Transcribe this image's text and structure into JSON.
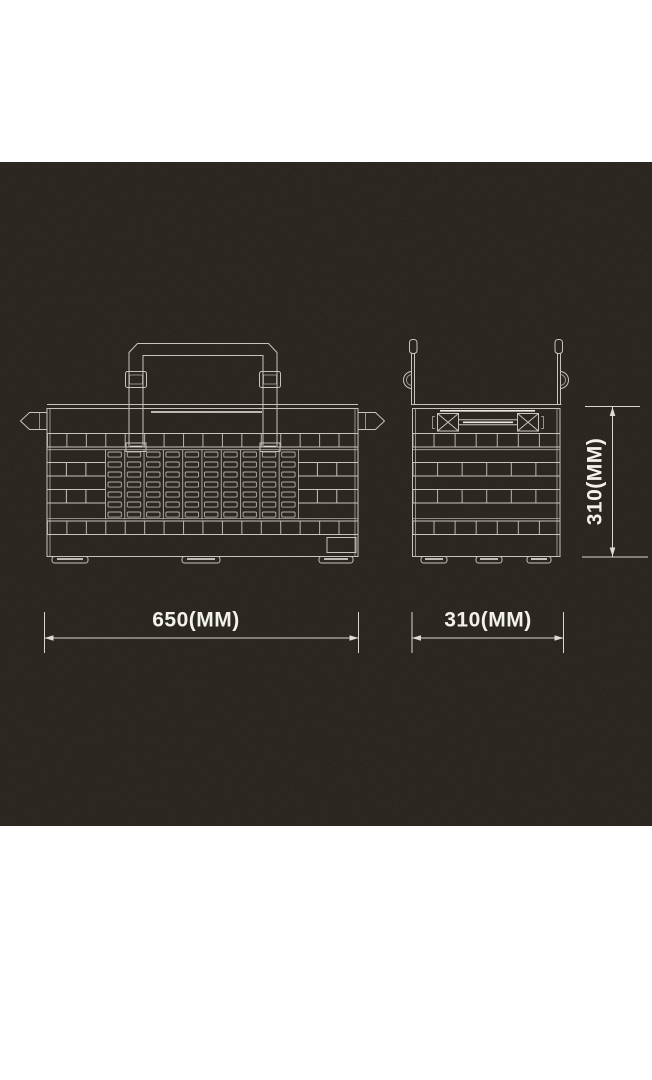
{
  "page": {
    "background_color": "#ffffff",
    "panel_color": "#25201a",
    "line_color": "#c8c4bd",
    "bright_line_color": "#eceae5",
    "label_color": "#f2f1ec"
  },
  "drawing": {
    "front_view": {
      "width_label": "650(MM)"
    },
    "side_view": {
      "width_label": "310(MM)",
      "height_label": "310(MM)"
    }
  }
}
